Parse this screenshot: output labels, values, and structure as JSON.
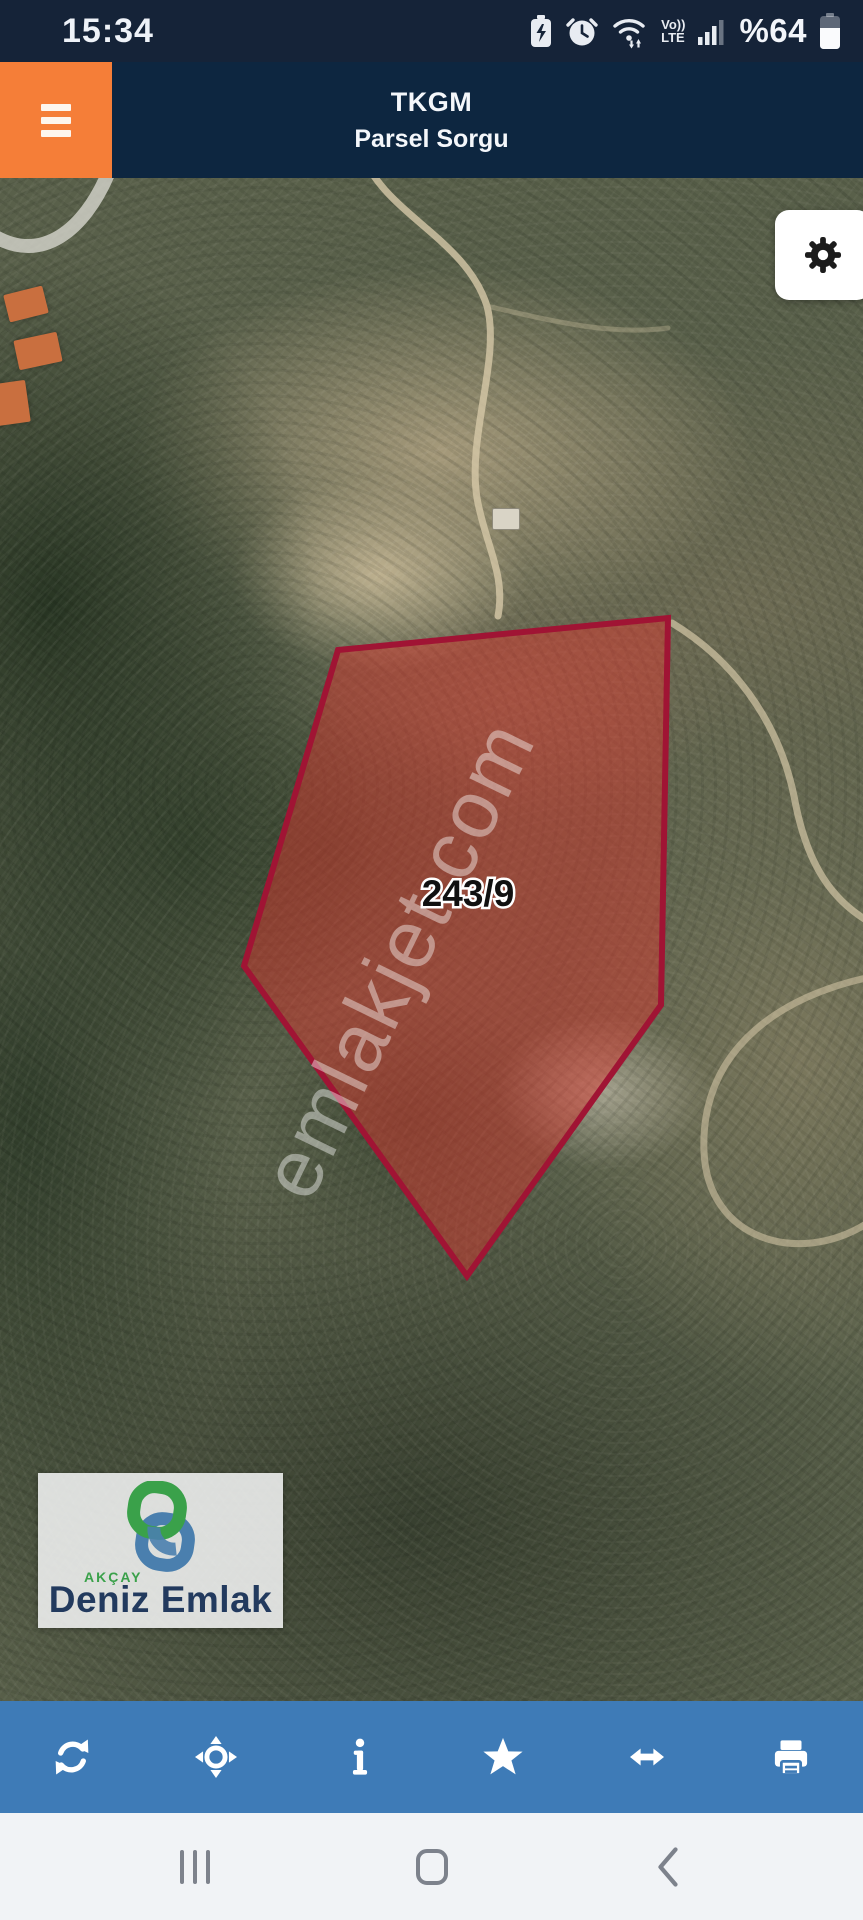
{
  "status_bar": {
    "time": "15:34",
    "battery_percent": "%64",
    "battery_level": 64,
    "volte_line1": "Vo))",
    "volte_line2": "LTE",
    "icons": [
      "battery-saver-icon",
      "alarm-icon",
      "wifi-icon",
      "volte-icon",
      "signal-icon",
      "battery-icon"
    ]
  },
  "app": {
    "title_line1": "TKGM",
    "title_line2": "Parsel Sorgu",
    "menu_icon": "hamburger-icon",
    "settings_icon": "gear-icon"
  },
  "map": {
    "type": "satellite",
    "parcel_label": "243/9",
    "watermark": "emlakjet.com",
    "parcel_polygon_points": "338,472 668,440 661,827 467,1098 244,788"
  },
  "branding": {
    "brand_top": "AKÇAY",
    "brand_name": "Deniz Emlak",
    "logo_icon": "interlocked-rings-icon"
  },
  "toolbar": {
    "items": [
      {
        "name": "refresh-icon"
      },
      {
        "name": "locate-icon"
      },
      {
        "name": "info-icon"
      },
      {
        "name": "favorite-star-icon"
      },
      {
        "name": "measure-horizontal-icon"
      },
      {
        "name": "print-icon"
      }
    ]
  },
  "nav_bar": {
    "items": [
      "recents-icon",
      "home-icon",
      "back-icon"
    ]
  },
  "colors": {
    "accent_orange": "#F57E38",
    "header_navy": "#0D2640",
    "status_navy": "#152338",
    "toolbar_blue": "#3E7BB7",
    "parcel_stroke": "#A01434",
    "parcel_fill": "rgba(219,55,45,0.48)",
    "logo_green": "#3AA14A",
    "logo_blue": "#4A7FAE",
    "logo_navy": "#223A5E"
  }
}
